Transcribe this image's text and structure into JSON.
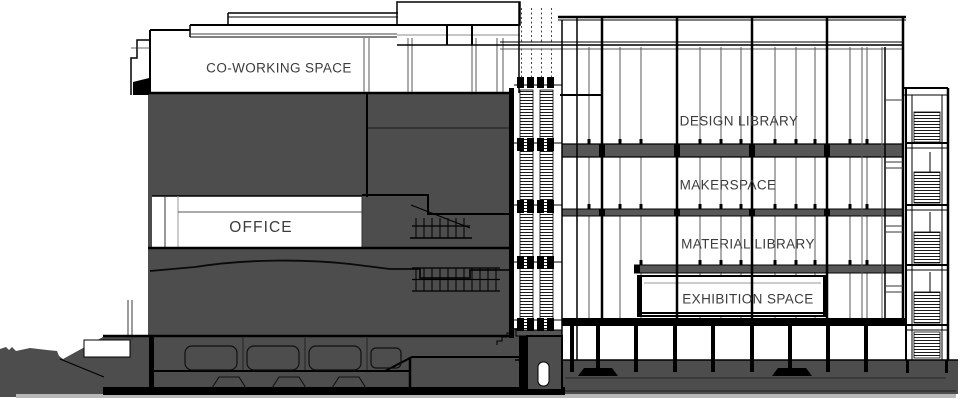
{
  "drawing": {
    "type_label": "building cross-section",
    "rooms_note": "labels visible on the section"
  },
  "rooms": [
    {
      "id": "co-working-space",
      "label": "CO-WORKING SPACE"
    },
    {
      "id": "office",
      "label": "OFFICE"
    },
    {
      "id": "design-library",
      "label": "DESIGN LIBRARY"
    },
    {
      "id": "makerspace",
      "label": "MAKERSPACE"
    },
    {
      "id": "material-library",
      "label": "MATERIAL LIBRARY"
    },
    {
      "id": "exhibition-space",
      "label": "EXHIBITION SPACE"
    }
  ],
  "colors": {
    "line": "#000000",
    "line_soft": "#5a5a5a",
    "poche": "#4d4d4d",
    "slab": "#575757",
    "ground_shadow": "#b8b8b8",
    "label_text": "#3c3c3c",
    "background": "#ffffff"
  }
}
